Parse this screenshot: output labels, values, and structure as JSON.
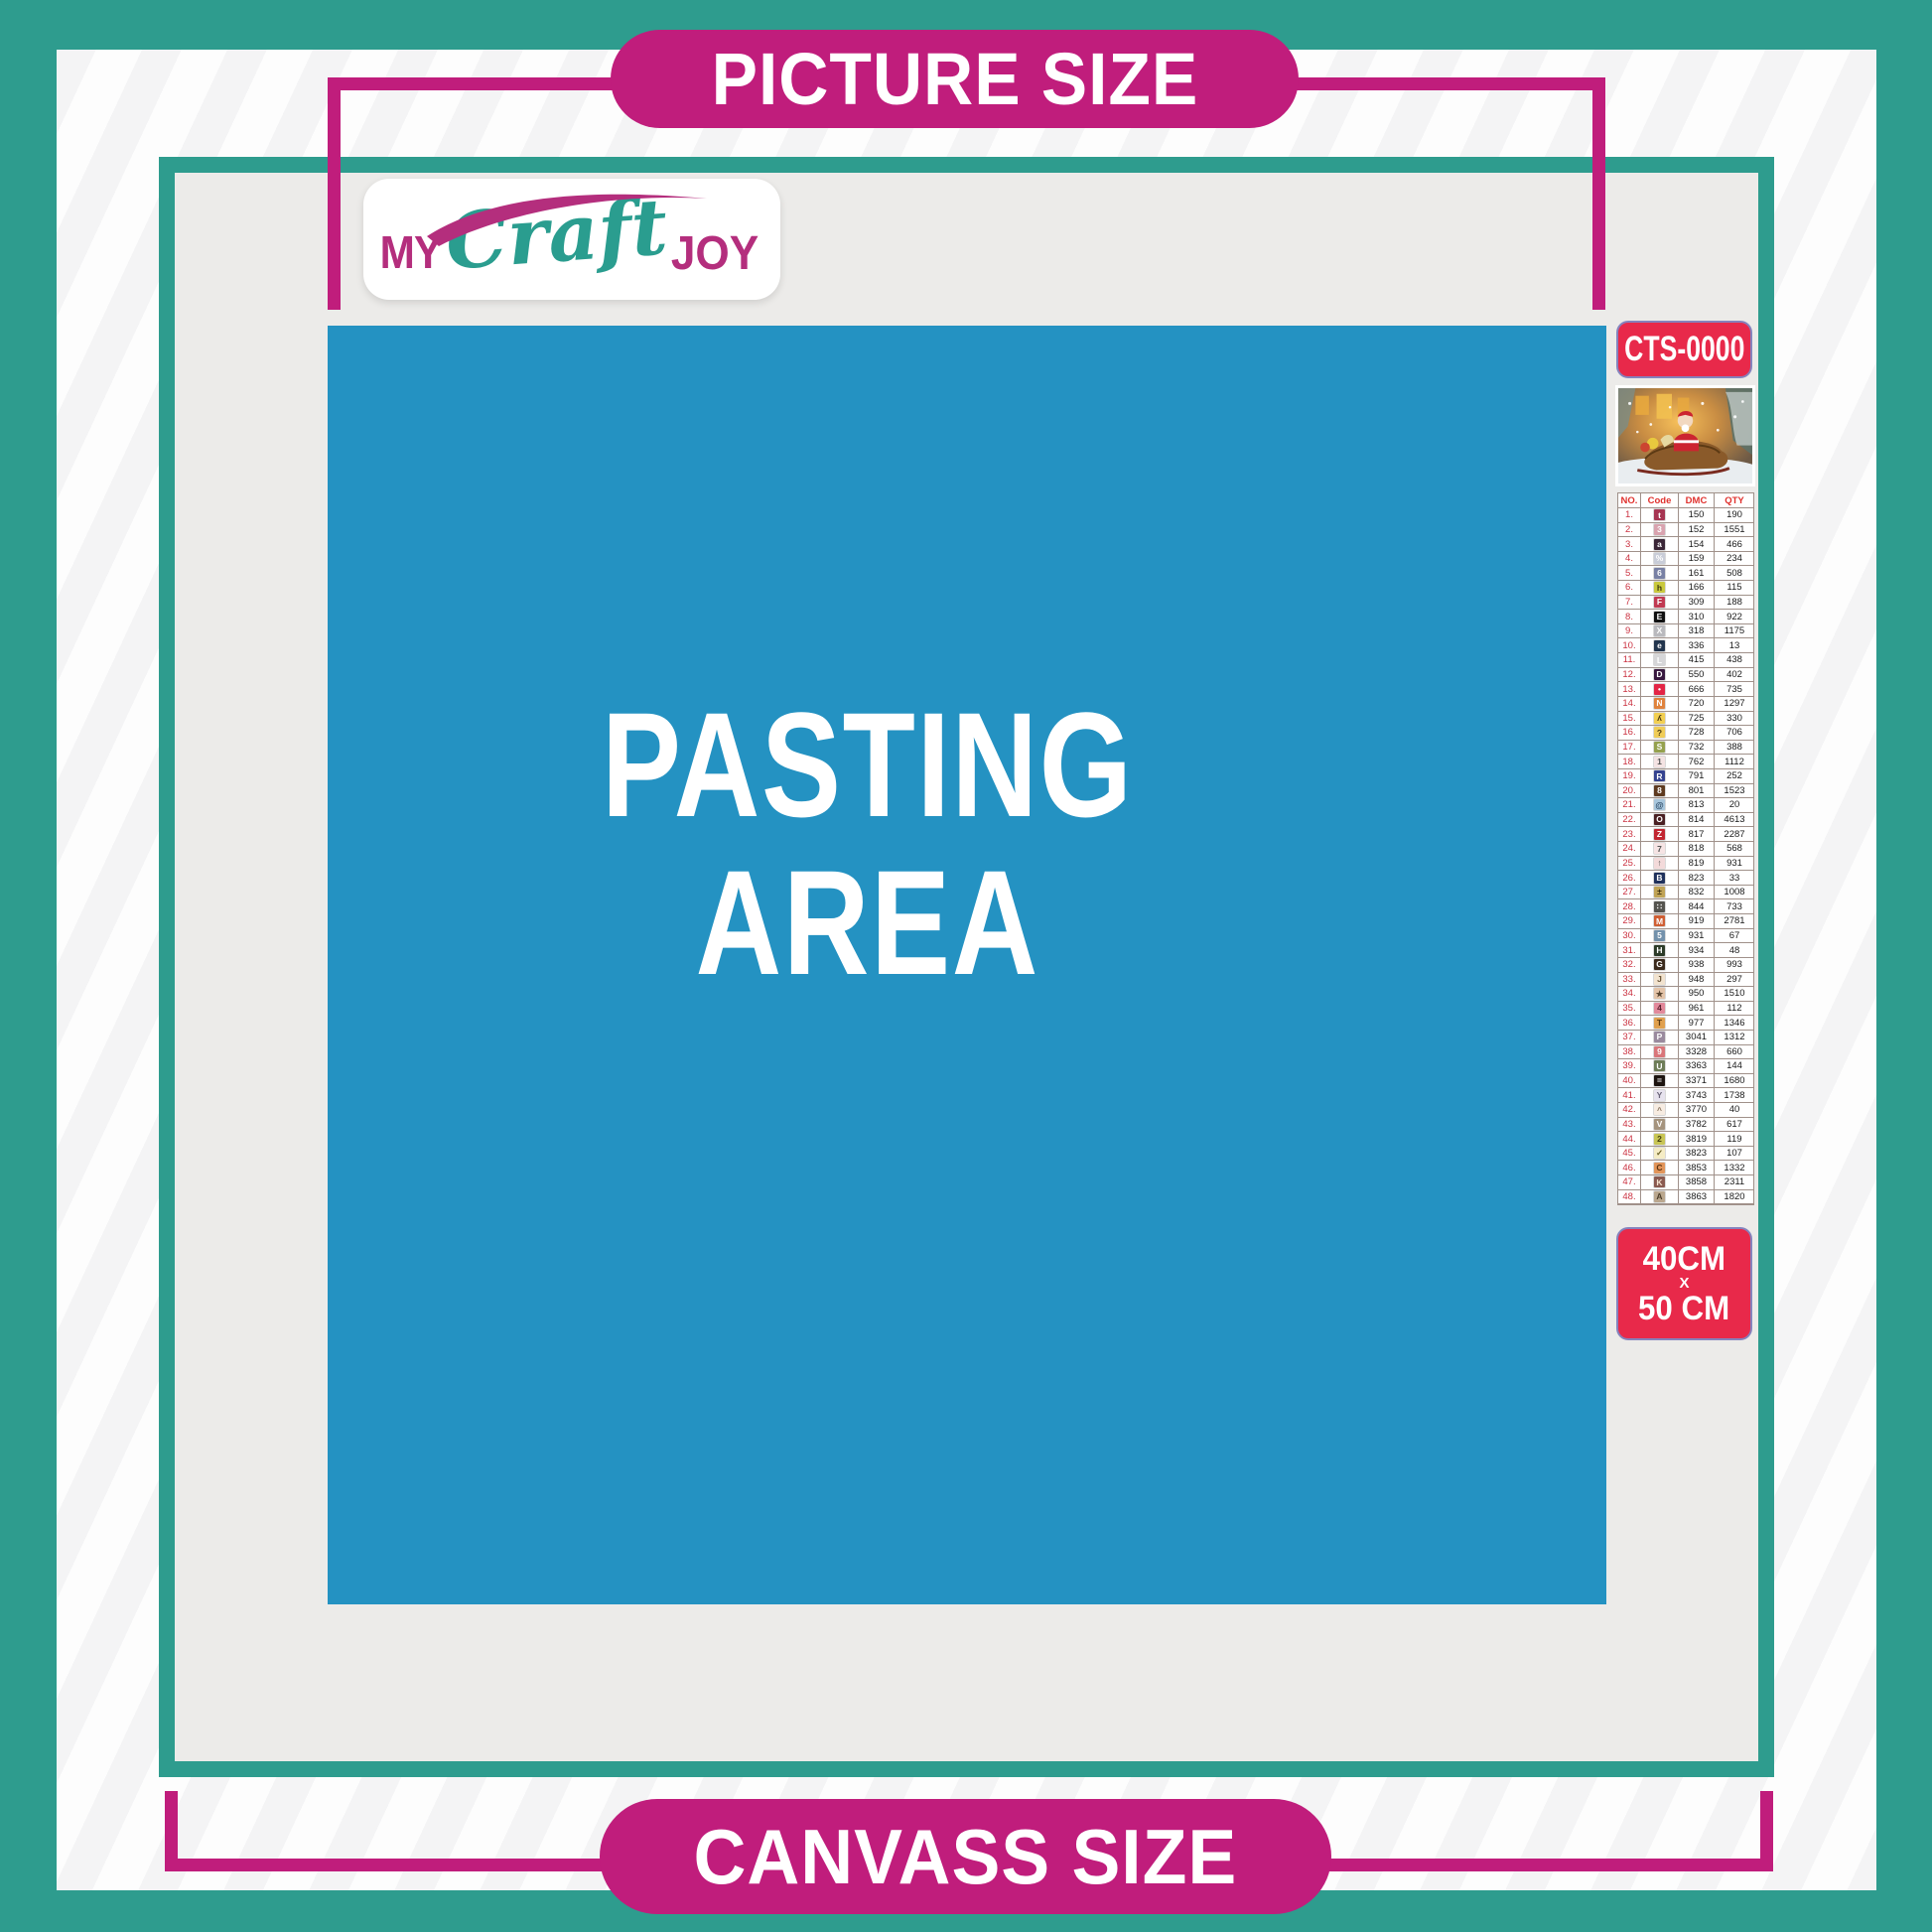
{
  "header_pill": {
    "label": "PICTURE SIZE"
  },
  "footer_pill": {
    "label": "CANVASS SIZE"
  },
  "logo": {
    "word1": "MY",
    "word2": "Craft",
    "word3": "JOY"
  },
  "pasting_area": {
    "line1": "PASTING",
    "line2": "AREA"
  },
  "sidebar": {
    "sku": "CTS-0000",
    "product_thumbnail": "christmas-santa-sleigh-scene",
    "size_label": {
      "line1": "40CM",
      "line2": "X",
      "line3": "50 CM"
    },
    "color_table": {
      "headers": [
        "NO.",
        "Code",
        "DMC",
        "QTY"
      ],
      "rows": [
        {
          "no": "1.",
          "symbol": "t",
          "symbol_bg": "#a63552",
          "symbol_fg": "#ffffff",
          "dmc": "150",
          "qty": "190"
        },
        {
          "no": "2.",
          "symbol": "3",
          "symbol_bg": "#d9a3af",
          "symbol_fg": "#ffffff",
          "dmc": "152",
          "qty": "1551"
        },
        {
          "no": "3.",
          "symbol": "a",
          "symbol_bg": "#3a2637",
          "symbol_fg": "#ffffff",
          "dmc": "154",
          "qty": "466"
        },
        {
          "no": "4.",
          "symbol": "%",
          "symbol_bg": "#c9cdd8",
          "symbol_fg": "#ffffff",
          "dmc": "159",
          "qty": "234"
        },
        {
          "no": "5.",
          "symbol": "6",
          "symbol_bg": "#7880a4",
          "symbol_fg": "#ffffff",
          "dmc": "161",
          "qty": "508"
        },
        {
          "no": "6.",
          "symbol": "h",
          "symbol_bg": "#c9c93e",
          "symbol_fg": "#3c3a10",
          "dmc": "166",
          "qty": "115"
        },
        {
          "no": "7.",
          "symbol": "F",
          "symbol_bg": "#c13a52",
          "symbol_fg": "#ffffff",
          "dmc": "309",
          "qty": "188"
        },
        {
          "no": "8.",
          "symbol": "E",
          "symbol_bg": "#111111",
          "symbol_fg": "#ffffff",
          "dmc": "310",
          "qty": "922"
        },
        {
          "no": "9.",
          "symbol": "X",
          "symbol_bg": "#b9b9bd",
          "symbol_fg": "#ffffff",
          "dmc": "318",
          "qty": "1175"
        },
        {
          "no": "10.",
          "symbol": "e",
          "symbol_bg": "#23354d",
          "symbol_fg": "#ffffff",
          "dmc": "336",
          "qty": "13"
        },
        {
          "no": "11.",
          "symbol": "L",
          "symbol_bg": "#d6d6d8",
          "symbol_fg": "#ffffff",
          "dmc": "415",
          "qty": "438"
        },
        {
          "no": "12.",
          "symbol": "D",
          "symbol_bg": "#38183f",
          "symbol_fg": "#ffffff",
          "dmc": "550",
          "qty": "402"
        },
        {
          "no": "13.",
          "symbol": "•",
          "symbol_bg": "#e32545",
          "symbol_fg": "#ffffff",
          "dmc": "666",
          "qty": "735"
        },
        {
          "no": "14.",
          "symbol": "N",
          "symbol_bg": "#e0833d",
          "symbol_fg": "#ffffff",
          "dmc": "720",
          "qty": "1297"
        },
        {
          "no": "15.",
          "symbol": "ʎ",
          "symbol_bg": "#f2cf52",
          "symbol_fg": "#4a3b12",
          "dmc": "725",
          "qty": "330"
        },
        {
          "no": "16.",
          "symbol": "?",
          "symbol_bg": "#f0cd58",
          "symbol_fg": "#4a3b12",
          "dmc": "728",
          "qty": "706"
        },
        {
          "no": "17.",
          "symbol": "S",
          "symbol_bg": "#95a14e",
          "symbol_fg": "#ffffff",
          "dmc": "732",
          "qty": "388"
        },
        {
          "no": "18.",
          "symbol": "1",
          "symbol_bg": "#f4e3e3",
          "symbol_fg": "#555555",
          "dmc": "762",
          "qty": "1112"
        },
        {
          "no": "19.",
          "symbol": "R",
          "symbol_bg": "#35438f",
          "symbol_fg": "#ffffff",
          "dmc": "791",
          "qty": "252"
        },
        {
          "no": "20.",
          "symbol": "8",
          "symbol_bg": "#5e3a1f",
          "symbol_fg": "#ffffff",
          "dmc": "801",
          "qty": "1523"
        },
        {
          "no": "21.",
          "symbol": "@",
          "symbol_bg": "#a8c6dc",
          "symbol_fg": "#2c4a66",
          "dmc": "813",
          "qty": "20"
        },
        {
          "no": "22.",
          "symbol": "O",
          "symbol_bg": "#4a2023",
          "symbol_fg": "#ffffff",
          "dmc": "814",
          "qty": "4613"
        },
        {
          "no": "23.",
          "symbol": "Z",
          "symbol_bg": "#c22631",
          "symbol_fg": "#ffffff",
          "dmc": "817",
          "qty": "2287"
        },
        {
          "no": "24.",
          "symbol": "7",
          "symbol_bg": "#f6e4e4",
          "symbol_fg": "#555555",
          "dmc": "818",
          "qty": "568"
        },
        {
          "no": "25.",
          "symbol": "↑",
          "symbol_bg": "#f3dada",
          "symbol_fg": "#555555",
          "dmc": "819",
          "qty": "931"
        },
        {
          "no": "26.",
          "symbol": "B",
          "symbol_bg": "#20315c",
          "symbol_fg": "#ffffff",
          "dmc": "823",
          "qty": "33"
        },
        {
          "no": "27.",
          "symbol": "±",
          "symbol_bg": "#c0a355",
          "symbol_fg": "#3c3010",
          "dmc": "832",
          "qty": "1008"
        },
        {
          "no": "28.",
          "symbol": "∷",
          "symbol_bg": "#55544f",
          "symbol_fg": "#ffffff",
          "dmc": "844",
          "qty": "733"
        },
        {
          "no": "29.",
          "symbol": "M",
          "symbol_bg": "#cf5e33",
          "symbol_fg": "#ffffff",
          "dmc": "919",
          "qty": "2781"
        },
        {
          "no": "30.",
          "symbol": "5",
          "symbol_bg": "#7391ab",
          "symbol_fg": "#ffffff",
          "dmc": "931",
          "qty": "67"
        },
        {
          "no": "31.",
          "symbol": "H",
          "symbol_bg": "#2c3b28",
          "symbol_fg": "#ffffff",
          "dmc": "934",
          "qty": "48"
        },
        {
          "no": "32.",
          "symbol": "G",
          "symbol_bg": "#3b2a1c",
          "symbol_fg": "#ffffff",
          "dmc": "938",
          "qty": "993"
        },
        {
          "no": "33.",
          "symbol": "J",
          "symbol_bg": "#f2e3cf",
          "symbol_fg": "#6a5538",
          "dmc": "948",
          "qty": "297"
        },
        {
          "no": "34.",
          "symbol": "★",
          "symbol_bg": "#e4c4a9",
          "symbol_fg": "#5a4632",
          "dmc": "950",
          "qty": "1510"
        },
        {
          "no": "35.",
          "symbol": "4",
          "symbol_bg": "#e2899b",
          "symbol_fg": "#5c2230",
          "dmc": "961",
          "qty": "112"
        },
        {
          "no": "36.",
          "symbol": "T",
          "symbol_bg": "#e0a04e",
          "symbol_fg": "#5c3a10",
          "dmc": "977",
          "qty": "1346"
        },
        {
          "no": "37.",
          "symbol": "P",
          "symbol_bg": "#9a8a9e",
          "symbol_fg": "#ffffff",
          "dmc": "3041",
          "qty": "1312"
        },
        {
          "no": "38.",
          "symbol": "9",
          "symbol_bg": "#d9767a",
          "symbol_fg": "#ffffff",
          "dmc": "3328",
          "qty": "660"
        },
        {
          "no": "39.",
          "symbol": "U",
          "symbol_bg": "#6e7d58",
          "symbol_fg": "#ffffff",
          "dmc": "3363",
          "qty": "144"
        },
        {
          "no": "40.",
          "symbol": "=",
          "symbol_bg": "#1d1410",
          "symbol_fg": "#ffffff",
          "dmc": "3371",
          "qty": "1680"
        },
        {
          "no": "41.",
          "symbol": "Y",
          "symbol_bg": "#e7e3ee",
          "symbol_fg": "#6a6478",
          "dmc": "3743",
          "qty": "1738"
        },
        {
          "no": "42.",
          "symbol": "^",
          "symbol_bg": "#f7ece2",
          "symbol_fg": "#8a7560",
          "dmc": "3770",
          "qty": "40"
        },
        {
          "no": "43.",
          "symbol": "V",
          "symbol_bg": "#a5947e",
          "symbol_fg": "#ffffff",
          "dmc": "3782",
          "qty": "617"
        },
        {
          "no": "44.",
          "symbol": "2",
          "symbol_bg": "#c8c555",
          "symbol_fg": "#44400f",
          "dmc": "3819",
          "qty": "119"
        },
        {
          "no": "45.",
          "symbol": "✓",
          "symbol_bg": "#f5ecc5",
          "symbol_fg": "#6a6024",
          "dmc": "3823",
          "qty": "107"
        },
        {
          "no": "46.",
          "symbol": "C",
          "symbol_bg": "#e2955a",
          "symbol_fg": "#5c3410",
          "dmc": "3853",
          "qty": "1332"
        },
        {
          "no": "47.",
          "symbol": "K",
          "symbol_bg": "#8a5a50",
          "symbol_fg": "#f5e3d0",
          "dmc": "3858",
          "qty": "2311"
        },
        {
          "no": "48.",
          "symbol": "A",
          "symbol_bg": "#baa78e",
          "symbol_fg": "#4a3c28",
          "dmc": "3863",
          "qty": "1820"
        }
      ]
    }
  },
  "colors": {
    "teal": "#2e9c8e",
    "magenta": "#c01d7c",
    "blue": "#2492c2",
    "badge_red": "#e8294a",
    "content_gray": "#ecebe9"
  }
}
